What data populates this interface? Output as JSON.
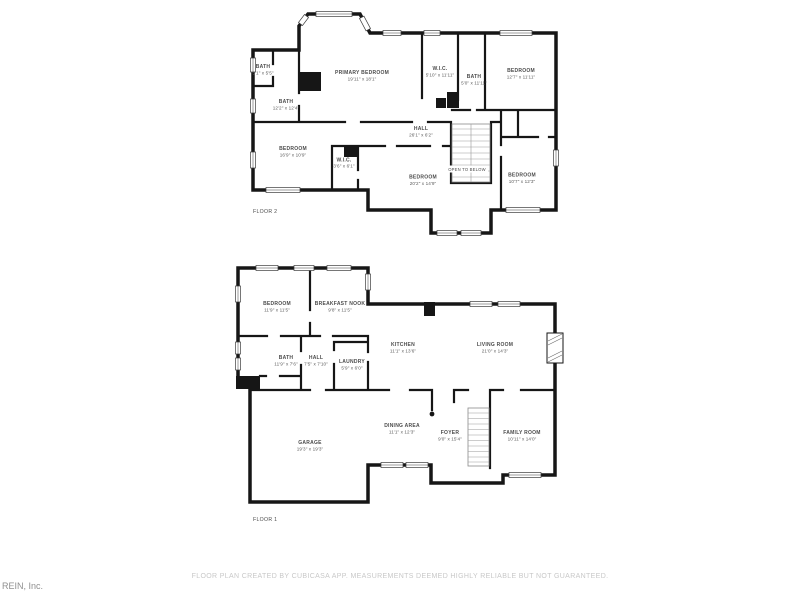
{
  "page": {
    "background": "#ffffff"
  },
  "colors": {
    "wall": "#161616",
    "room_label": "#4c4c4c",
    "footer_text": "#c8c8c8",
    "watermark_text": "#8f8f8f"
  },
  "branding": {
    "watermark": "REIN, Inc."
  },
  "footer": {
    "disclaimer": "FLOOR PLAN CREATED BY CUBICASA APP. MEASUREMENTS DEEMED HIGHLY RELIABLE BUT NOT GUARANTEED."
  },
  "floors": [
    {
      "id": "floor-2",
      "label": "FLOOR 2",
      "rooms": [
        {
          "name": "BATH",
          "dims": "5'1\" x 5'5\""
        },
        {
          "name": "BATH",
          "dims": "12'2\" x 12'4\""
        },
        {
          "name": "PRIMARY BEDROOM",
          "dims": "19'11\" x 18'1\""
        },
        {
          "name": "W.I.C.",
          "dims": "5'10\" x 11'11\""
        },
        {
          "name": "BATH",
          "dims": "5'0\" x 11'11\""
        },
        {
          "name": "BEDROOM",
          "dims": "12'7\" x 11'11\""
        },
        {
          "name": "HALL",
          "dims": "26'1\" x 6'2\""
        },
        {
          "name": "BEDROOM",
          "dims": "16'9\" x 10'9\""
        },
        {
          "name": "W.I.C.",
          "dims": "3'6\" x 6'1\""
        },
        {
          "name": "BEDROOM",
          "dims": "20'2\" x 14'9\""
        },
        {
          "name": "OPEN TO BELOW",
          "dims": ""
        },
        {
          "name": "BEDROOM",
          "dims": "10'7\" x 12'3\""
        }
      ]
    },
    {
      "id": "floor-1",
      "label": "FLOOR 1",
      "rooms": [
        {
          "name": "BEDROOM",
          "dims": "11'9\" x 11'5\""
        },
        {
          "name": "BREAKFAST NOOK",
          "dims": "9'8\" x 11'5\""
        },
        {
          "name": "KITCHEN",
          "dims": "11'1\" x 13'6\""
        },
        {
          "name": "LIVING ROOM",
          "dims": "21'0\" x 14'3\""
        },
        {
          "name": "BATH",
          "dims": "11'9\" x 7'6\""
        },
        {
          "name": "HALL",
          "dims": "7'5\" x 7'10\""
        },
        {
          "name": "LAUNDRY",
          "dims": "5'9\" x 6'0\""
        },
        {
          "name": "GARAGE",
          "dims": "19'3\" x 19'3\""
        },
        {
          "name": "DINING AREA",
          "dims": "11'1\" x 12'3\""
        },
        {
          "name": "FOYER",
          "dims": "9'0\" x 15'4\""
        },
        {
          "name": "FAMILY ROOM",
          "dims": "10'11\" x 14'0\""
        }
      ]
    }
  ]
}
